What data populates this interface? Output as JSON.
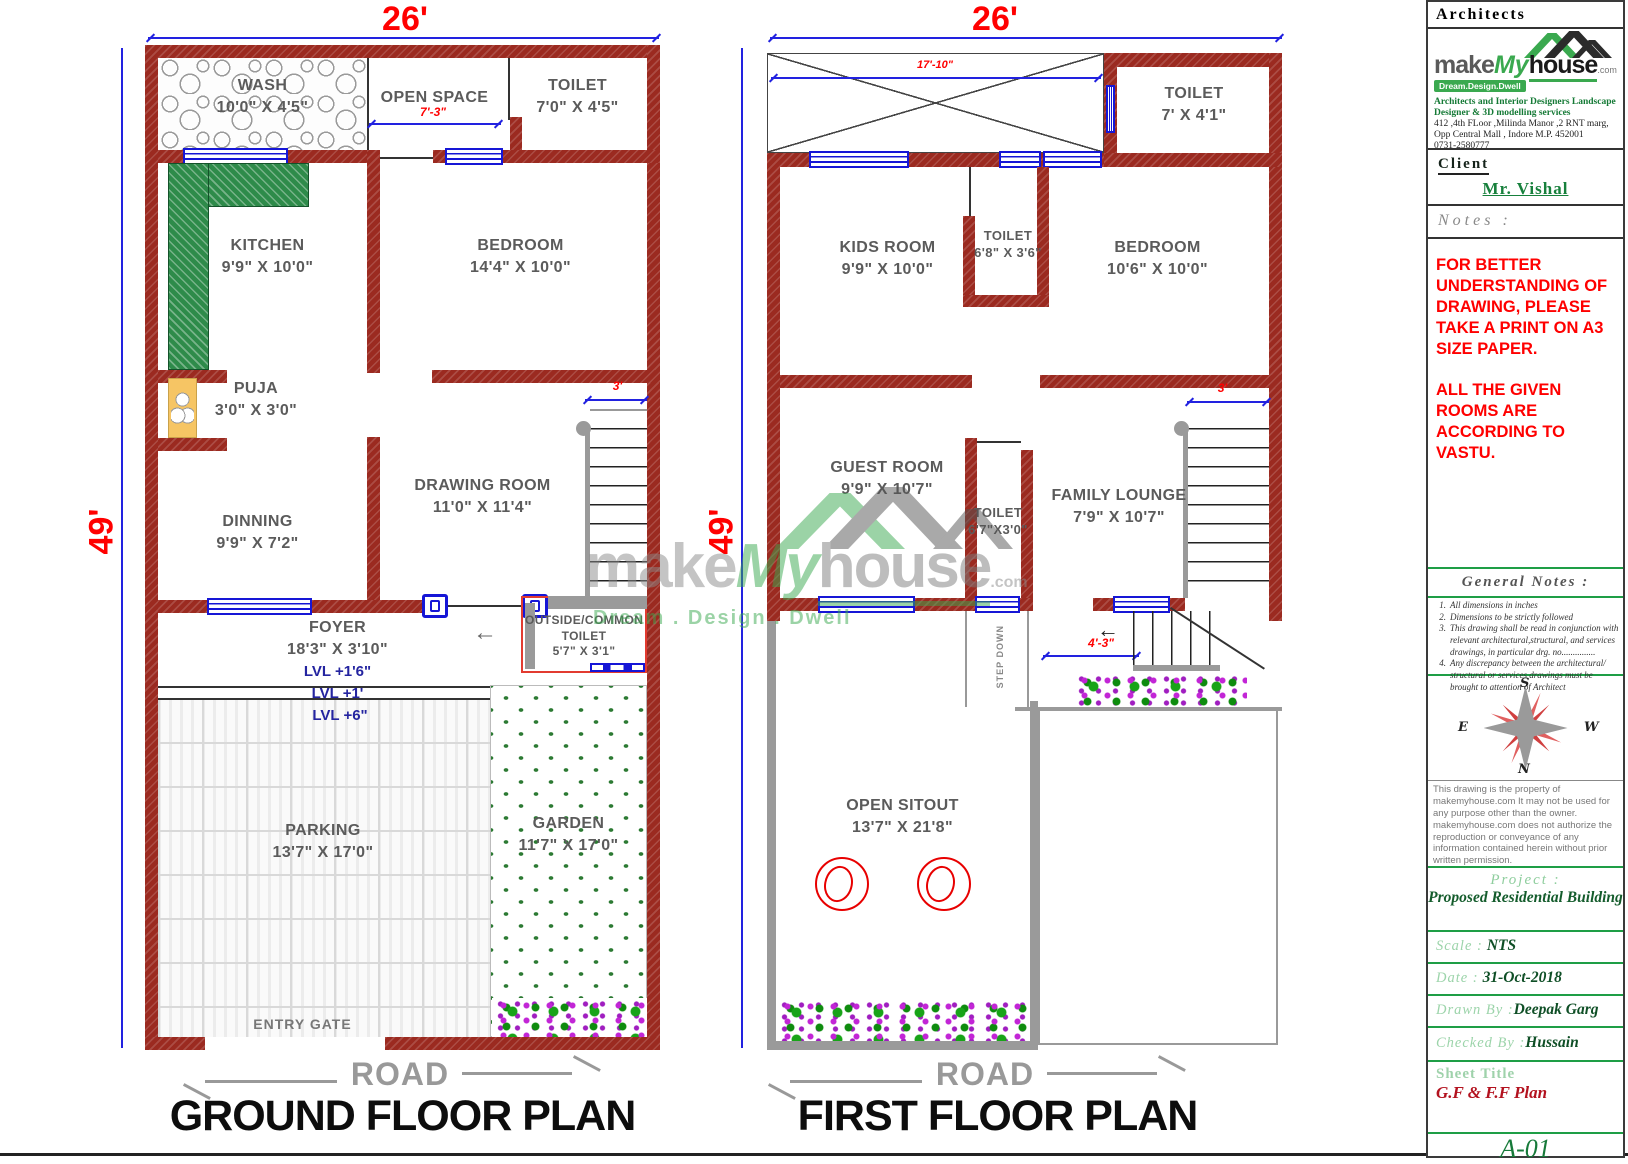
{
  "brand": {
    "make": "make",
    "my": "My",
    "house": "house",
    "com": ".com",
    "tagline": "Dream.Design.Dwell",
    "tagline_wide": "Dream . Design . Dwell"
  },
  "ground_floor": {
    "title": "GROUND FLOOR PLAN",
    "road": "ROAD",
    "entry_gate": "ENTRY GATE",
    "dims": {
      "width": "26'",
      "height": "49'",
      "open_space": "7'-3\"",
      "stair": "3'"
    },
    "levels": {
      "foyer": "LVL +1'6\"",
      "mid": "LVL +1'",
      "low": "LVL +6\""
    },
    "rooms": {
      "wash": {
        "name": "WASH",
        "size": "10'0\" X 4'5\""
      },
      "open_space": {
        "name": "OPEN SPACE",
        "size": ""
      },
      "toilet": {
        "name": "TOILET",
        "size": "7'0\" X 4'5\""
      },
      "kitchen": {
        "name": "KITCHEN",
        "size": "9'9\" X 10'0\""
      },
      "bedroom": {
        "name": "BEDROOM",
        "size": "14'4\" X 10'0\""
      },
      "puja": {
        "name": "PUJA",
        "size": "3'0\" X 3'0\""
      },
      "dinning": {
        "name": "DINNING",
        "size": "9'9\" X 7'2\""
      },
      "drawing_room": {
        "name": "DRAWING ROOM",
        "size": "11'0\" X 11'4\""
      },
      "foyer": {
        "name": "FOYER",
        "size": "18'3\" X 3'10\""
      },
      "outside_toilet": {
        "line1": "OUTSIDE/COMMON",
        "line2": "TOILET",
        "size": "5'7\" X 3'1\""
      },
      "parking": {
        "name": "PARKING",
        "size": "13'7\" X 17'0\""
      },
      "garden": {
        "name": "GARDEN",
        "size": "11'7\" X 17'0\""
      }
    }
  },
  "first_floor": {
    "title": "FIRST FLOOR PLAN",
    "road": "ROAD",
    "dims": {
      "width": "26'",
      "height": "49'",
      "terrace": "17'-10\"",
      "stair": "3'",
      "step": "4'-3\"",
      "step_down": "STEP DOWN"
    },
    "rooms": {
      "toilet_top": {
        "name": "TOILET",
        "size": "7' X 4'1\""
      },
      "kids_room": {
        "name": "KIDS ROOM",
        "size": "9'9\" X 10'0\""
      },
      "toilet_mid": {
        "name": "TOILET",
        "size": "6'8\" X 3'6\""
      },
      "bedroom": {
        "name": "BEDROOM",
        "size": "10'6\" X 10'0\""
      },
      "guest_room": {
        "name": "GUEST ROOM",
        "size": "9'9\" X 10'7\""
      },
      "toilet_low": {
        "name": "TOILET",
        "size": "6'7\"X3'0\""
      },
      "family_lounge": {
        "name": "FAMILY LOUNGE",
        "size": "7'9\" X 10'7\""
      },
      "open_sitout": {
        "name": "OPEN SITOUT",
        "size": "13'7\" X 21'8\""
      }
    }
  },
  "title_block": {
    "header": "Architects",
    "firm": {
      "line1": "Architects and Interior Designers Landscape",
      "line2": "Designer & 3D modelling services",
      "address1": "412  ,4th FLoor ,Milinda Manor ,2 RNT marg,",
      "address2": "Opp Central Mall , Indore M.P. 452001",
      "phone": "0731-2580777"
    },
    "client_label": "Client",
    "client_name": "Mr. Vishal",
    "notes_label": "Notes :",
    "notes": [
      "FOR BETTER UNDERSTANDING OF DRAWING, PLEASE TAKE A PRINT ON A3 SIZE PAPER.",
      "ALL THE GIVEN ROOMS ARE ACCORDING TO VASTU."
    ],
    "general_notes_label": "General Notes :",
    "general_notes": [
      {
        "num": "1.",
        "text": "All dimensions in inches"
      },
      {
        "num": "2.",
        "text": "Dimensions to be strictly followed"
      },
      {
        "num": "3.",
        "text": "This drawing shall be read in conjunction with relevant architectural,structural, and services drawings, in particular drg. no..............."
      },
      {
        "num": "4.",
        "text": "Any discrepancy between the architectural/ structural or services drawings must be brought to attention of  Architect"
      }
    ],
    "compass": {
      "n": "N",
      "s": "S",
      "e": "E",
      "w": "W"
    },
    "copyright": "This drawing is the property of makemyhouse.com  It may not be used for any purpose other than the owner. makemyhouse.com does not authorize the reproduction or conveyance of any information contained herein without prior written permission.",
    "project_label": "Project :",
    "project_name": "Proposed Residential Building",
    "scale_label": "Scale :",
    "scale_value": "NTS",
    "date_label": "Date :",
    "date_value": "31-Oct-2018",
    "drawn_label": "Drawn By :",
    "drawn_value": "Deepak Garg",
    "checked_label": "Checked By :",
    "checked_value": "Hussain",
    "sheet_title_label": "Sheet Title",
    "sheet_title_value": "G.F & F.F Plan",
    "sheet_no": "A-01"
  }
}
